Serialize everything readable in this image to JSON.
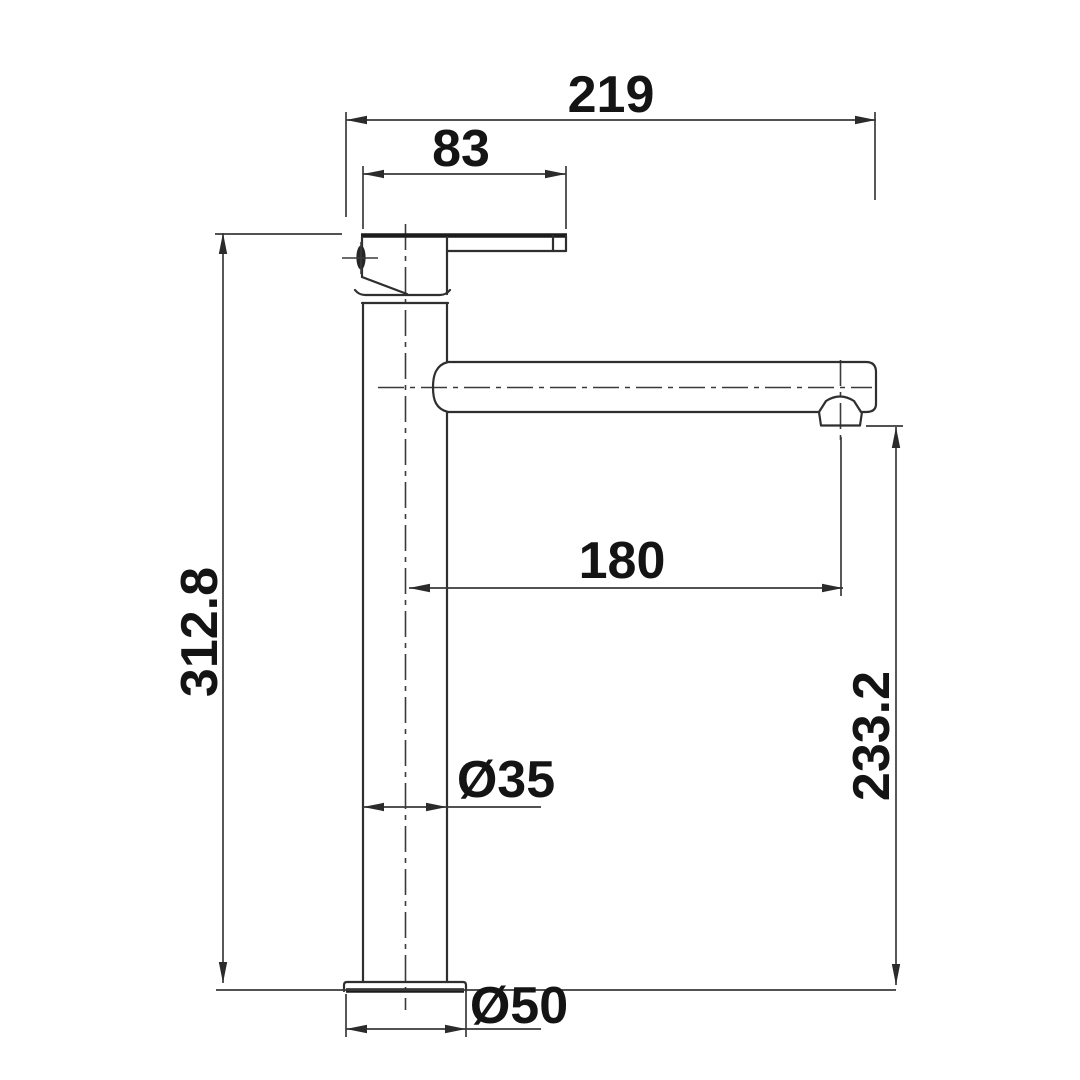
{
  "drawing": {
    "type": "technical-dimension-drawing",
    "subject": "tall basin mixer faucet side elevation",
    "background_color": "#ffffff",
    "line_color": "#2f2f2f",
    "text_color": "#141414",
    "dims": {
      "overall_width": {
        "label": "219",
        "value": 219,
        "orientation": "horizontal"
      },
      "handle_width": {
        "label": "83",
        "value": 83,
        "orientation": "horizontal"
      },
      "overall_height": {
        "label": "312.8",
        "value": 312.8,
        "orientation": "vertical"
      },
      "spout_reach": {
        "label": "180",
        "value": 180,
        "orientation": "horizontal"
      },
      "spout_outlet_height": {
        "label": "233.2",
        "value": 233.2,
        "orientation": "vertical"
      },
      "body_diameter": {
        "label": "Ø35",
        "value": 35,
        "orientation": "horizontal"
      },
      "base_diameter": {
        "label": "Ø50",
        "value": 50,
        "orientation": "horizontal"
      }
    }
  }
}
